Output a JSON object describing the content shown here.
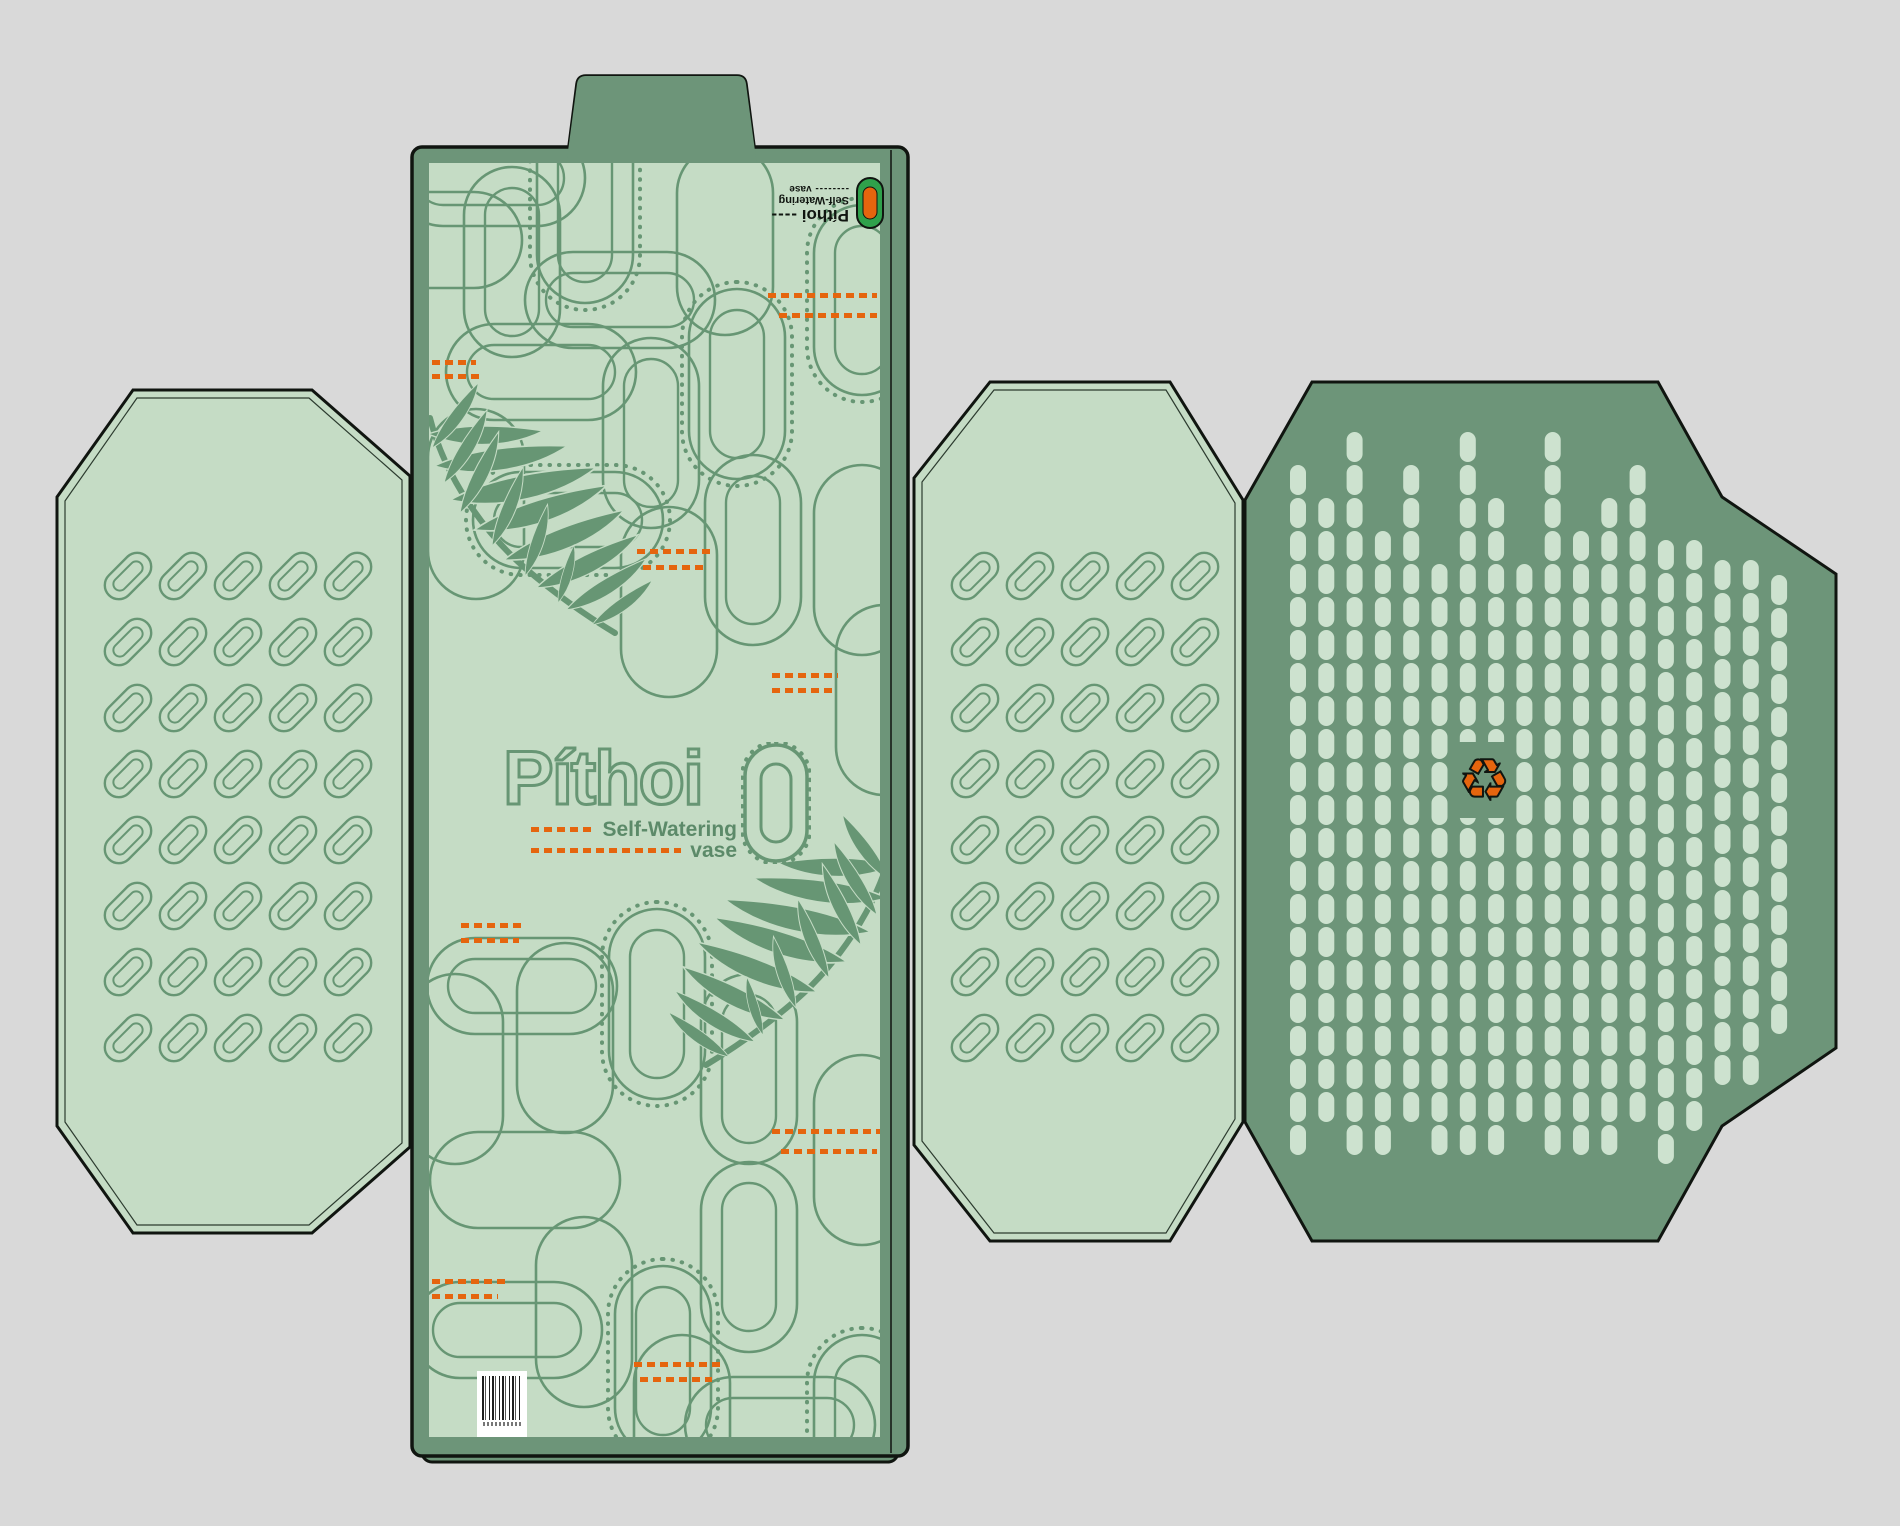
{
  "product": {
    "name": "Píthoi",
    "subtitle": "Self-Watering",
    "subtitle_word": "vase"
  },
  "brand_logo": {
    "name": "Píthoi",
    "name_dashes": "----",
    "tagline": "Self-Watering",
    "vase_dashes": "--------",
    "vase_word": "vase"
  },
  "recycle_symbol": "♻",
  "colors": {
    "background_gray": "#d9d9d9",
    "panel_light_green": "#c5dcc5",
    "panel_dark_sage": "#6d9579",
    "pattern_green": "#679674",
    "accent_orange": "#e5650e",
    "dot_light": "#cde2cf",
    "cut_line_black": "#101510",
    "logo_icon_green": "#2fa14b"
  },
  "decor": {
    "small_grid": {
      "cols": 5,
      "rows": 8,
      "dx": 55,
      "dy": 66,
      "outer_w": 54,
      "outer_h": 28,
      "inner_w": 36,
      "inner_h": 13,
      "angle": -45,
      "origins": [
        [
          128,
          576
        ],
        [
          975,
          576
        ]
      ]
    },
    "big_capsules": [
      [
        490,
        178,
        "h",
        1
      ],
      [
        585,
        208,
        "v",
        2
      ],
      [
        512,
        262,
        "v",
        1
      ],
      [
        620,
        300,
        "h",
        1
      ],
      [
        427,
        240,
        "h",
        0
      ],
      [
        725,
        240,
        "v",
        0
      ],
      [
        862,
        300,
        "v",
        2
      ],
      [
        541,
        372,
        "h",
        1
      ],
      [
        651,
        433,
        "v",
        1
      ],
      [
        737,
        384,
        "v",
        2
      ],
      [
        476,
        504,
        "v",
        0
      ],
      [
        568,
        520,
        "h",
        2
      ],
      [
        753,
        550,
        "v",
        1
      ],
      [
        669,
        602,
        "v",
        0
      ],
      [
        862,
        560,
        "v",
        0
      ],
      [
        884,
        700,
        "v",
        0
      ],
      [
        522,
        986,
        "h",
        1
      ],
      [
        455,
        1069,
        "v",
        0
      ],
      [
        565,
        1038,
        "v",
        0
      ],
      [
        657,
        1004,
        "v",
        2
      ],
      [
        749,
        1069,
        "v",
        1
      ],
      [
        525,
        1180,
        "h",
        0
      ],
      [
        584,
        1312,
        "v",
        0
      ],
      [
        663,
        1361,
        "v",
        2
      ],
      [
        507,
        1330,
        "h",
        1
      ],
      [
        682,
        1430,
        "v",
        0
      ],
      [
        749,
        1257,
        "v",
        1
      ],
      [
        862,
        1150,
        "v",
        0
      ],
      [
        780,
        1425,
        "h",
        1
      ],
      [
        862,
        1430,
        "v",
        2
      ]
    ],
    "dot_columns": {
      "x0": 1298,
      "dx": 28.3,
      "w": 16,
      "h": 30,
      "dy": 33,
      "tops": [
        465,
        498,
        432,
        531,
        465,
        564,
        432,
        498,
        564,
        432,
        531,
        498,
        465,
        540,
        540,
        560,
        560,
        575
      ],
      "bottoms": [
        1180,
        1147,
        1180,
        1180,
        1147,
        1180,
        1180,
        1180,
        1147,
        1180,
        1180,
        1180,
        1147,
        1180,
        1147,
        1085,
        1085,
        1060
      ]
    },
    "dash_marks": [
      [
        768,
        293,
        109
      ],
      [
        779,
        313,
        98
      ],
      [
        432,
        360,
        44
      ],
      [
        432,
        374,
        50
      ],
      [
        637,
        549,
        76
      ],
      [
        643,
        565,
        64
      ],
      [
        772,
        673,
        66
      ],
      [
        772,
        688,
        60
      ],
      [
        461,
        923,
        64
      ],
      [
        461,
        938,
        58
      ],
      [
        772,
        1129,
        108
      ],
      [
        781,
        1149,
        96
      ],
      [
        432,
        1279,
        74
      ],
      [
        432,
        1294,
        66
      ],
      [
        634,
        1362,
        86
      ],
      [
        640,
        1377,
        72
      ]
    ]
  }
}
